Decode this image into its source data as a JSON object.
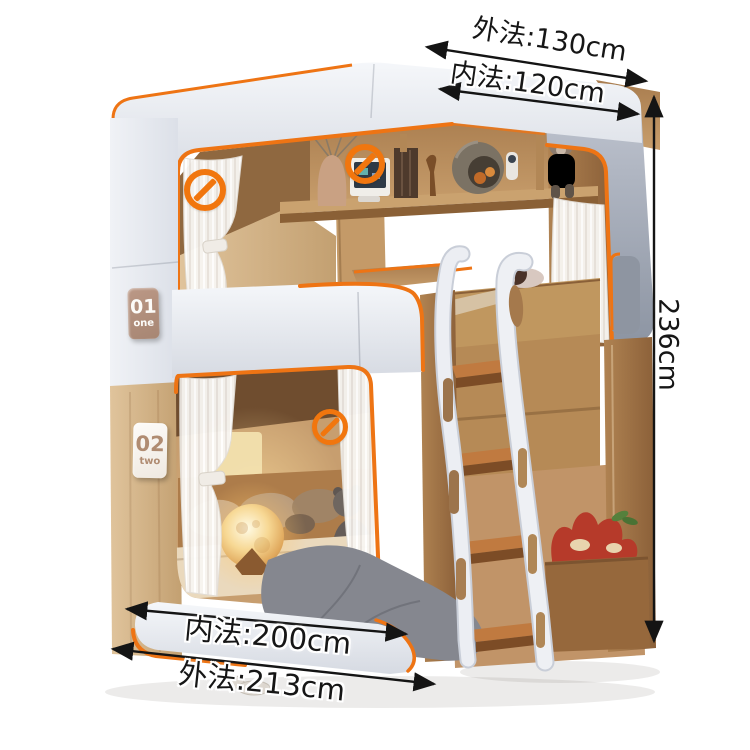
{
  "scene": {
    "type": "furniture product photo",
    "subject": "capsule-style kids bunk bed with ladder, shelf and curtains",
    "background": "#ffffff"
  },
  "colors": {
    "accent_orange": "#ee7414",
    "canopy_white": "#e9ecf2",
    "canopy_grey": "#949caa",
    "wood_light": "#d9bb92",
    "wood_dark": "#a0713f",
    "arrow_black": "#141414",
    "badge_tan": "#b19080",
    "moon_lamp": "#f7d894",
    "blanket_grey": "#85878f",
    "plush_red": "#b63a2a"
  },
  "annotations": {
    "top_outer_width": "外法:130cm",
    "top_inner_width": "内法:120cm",
    "side_height": "236cm",
    "bottom_inner_length": "内法:200cm",
    "bottom_outer_length": "外法:213cm"
  },
  "badges": {
    "bunk_one": {
      "number": "01",
      "label": "one"
    },
    "bunk_two": {
      "number": "02",
      "label": "two"
    }
  },
  "icons": {
    "prohibition": "no-sign (orange circle with diagonal slash), 3 instances"
  }
}
